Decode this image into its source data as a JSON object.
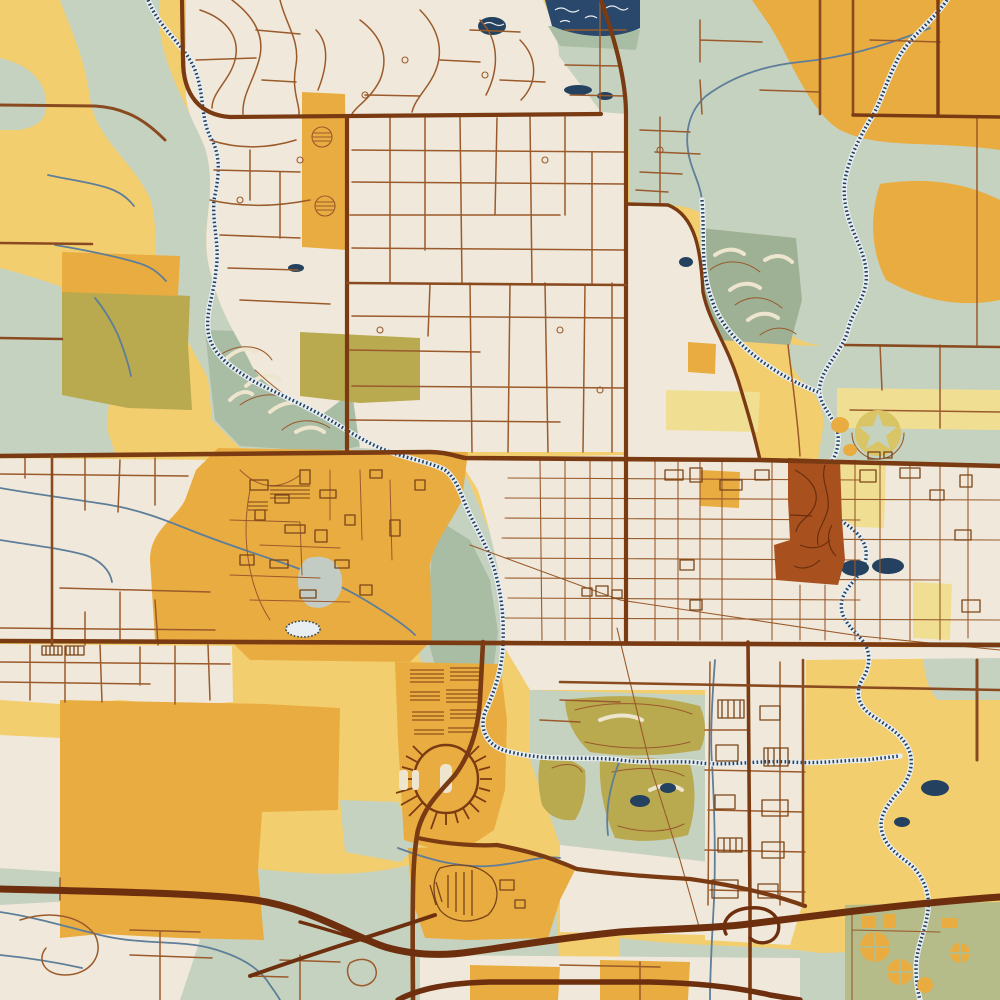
{
  "map": {
    "title": "Stylized vintage-print street map of a midwestern college city",
    "style": "art-print cartography: cream urban fabric, golden fields, sage river corridors, brown road network, hatched navy waterways",
    "palette": {
      "base": "#F2CE6E",
      "cream": "#F0E9DB",
      "sage": "#C6D2C0",
      "sageDark": "#A9BCA4",
      "sageDeep": "#9EB195",
      "olive": "#B9A94F",
      "oliveSoft": "#B5BC8A",
      "gold": "#E9AC41",
      "paleYellow": "#F0DF92",
      "rust": "#A8511F",
      "roadMinor": "#9A5A2B",
      "roadMed": "#8A4A1F",
      "roadMajor": "#7A3A12",
      "highway": "#6E2F0E",
      "water": "#5E7E99",
      "waterHatch": "#24415F",
      "waterLight": "#E8EEF2",
      "pondGrey": "#C2CBC4",
      "creamStripe": "#EDE5CE",
      "woods": "#29486B",
      "buildings": "#7A4418",
      "starCircle": "#D9C565"
    },
    "features": [
      {
        "id": "nw-creek-corridor",
        "label": "hatched creek through sage greenbelt, upper left"
      },
      {
        "id": "north-suburbs",
        "label": "curvy residential loops on cream, upper middle"
      },
      {
        "id": "grand-avenue",
        "label": "major vertical road through town center"
      },
      {
        "id": "lincoln-way",
        "label": "major horizontal road across mid map"
      },
      {
        "id": "campus",
        "label": "golden university campus with building footprints"
      },
      {
        "id": "downtown-grid",
        "label": "dense rectangular street grid right of creek"
      },
      {
        "id": "cemetery-block",
        "label": "rust-red block with winding paths"
      },
      {
        "id": "star-park",
        "label": "circular park with sage star, mid right"
      },
      {
        "id": "stadium",
        "label": "oval stadium with radial stands and parking stripes"
      },
      {
        "id": "golf-courses",
        "label": "striped fairway golf grounds, NW / NE / SE"
      },
      {
        "id": "skunk-river",
        "label": "meandering hatched river, right side"
      },
      {
        "id": "us30-highway",
        "label": "thick highway sweeping across the bottom with interchanges"
      },
      {
        "id": "water-treatment",
        "label": "circular clarifier tanks, bottom right corner"
      }
    ]
  }
}
